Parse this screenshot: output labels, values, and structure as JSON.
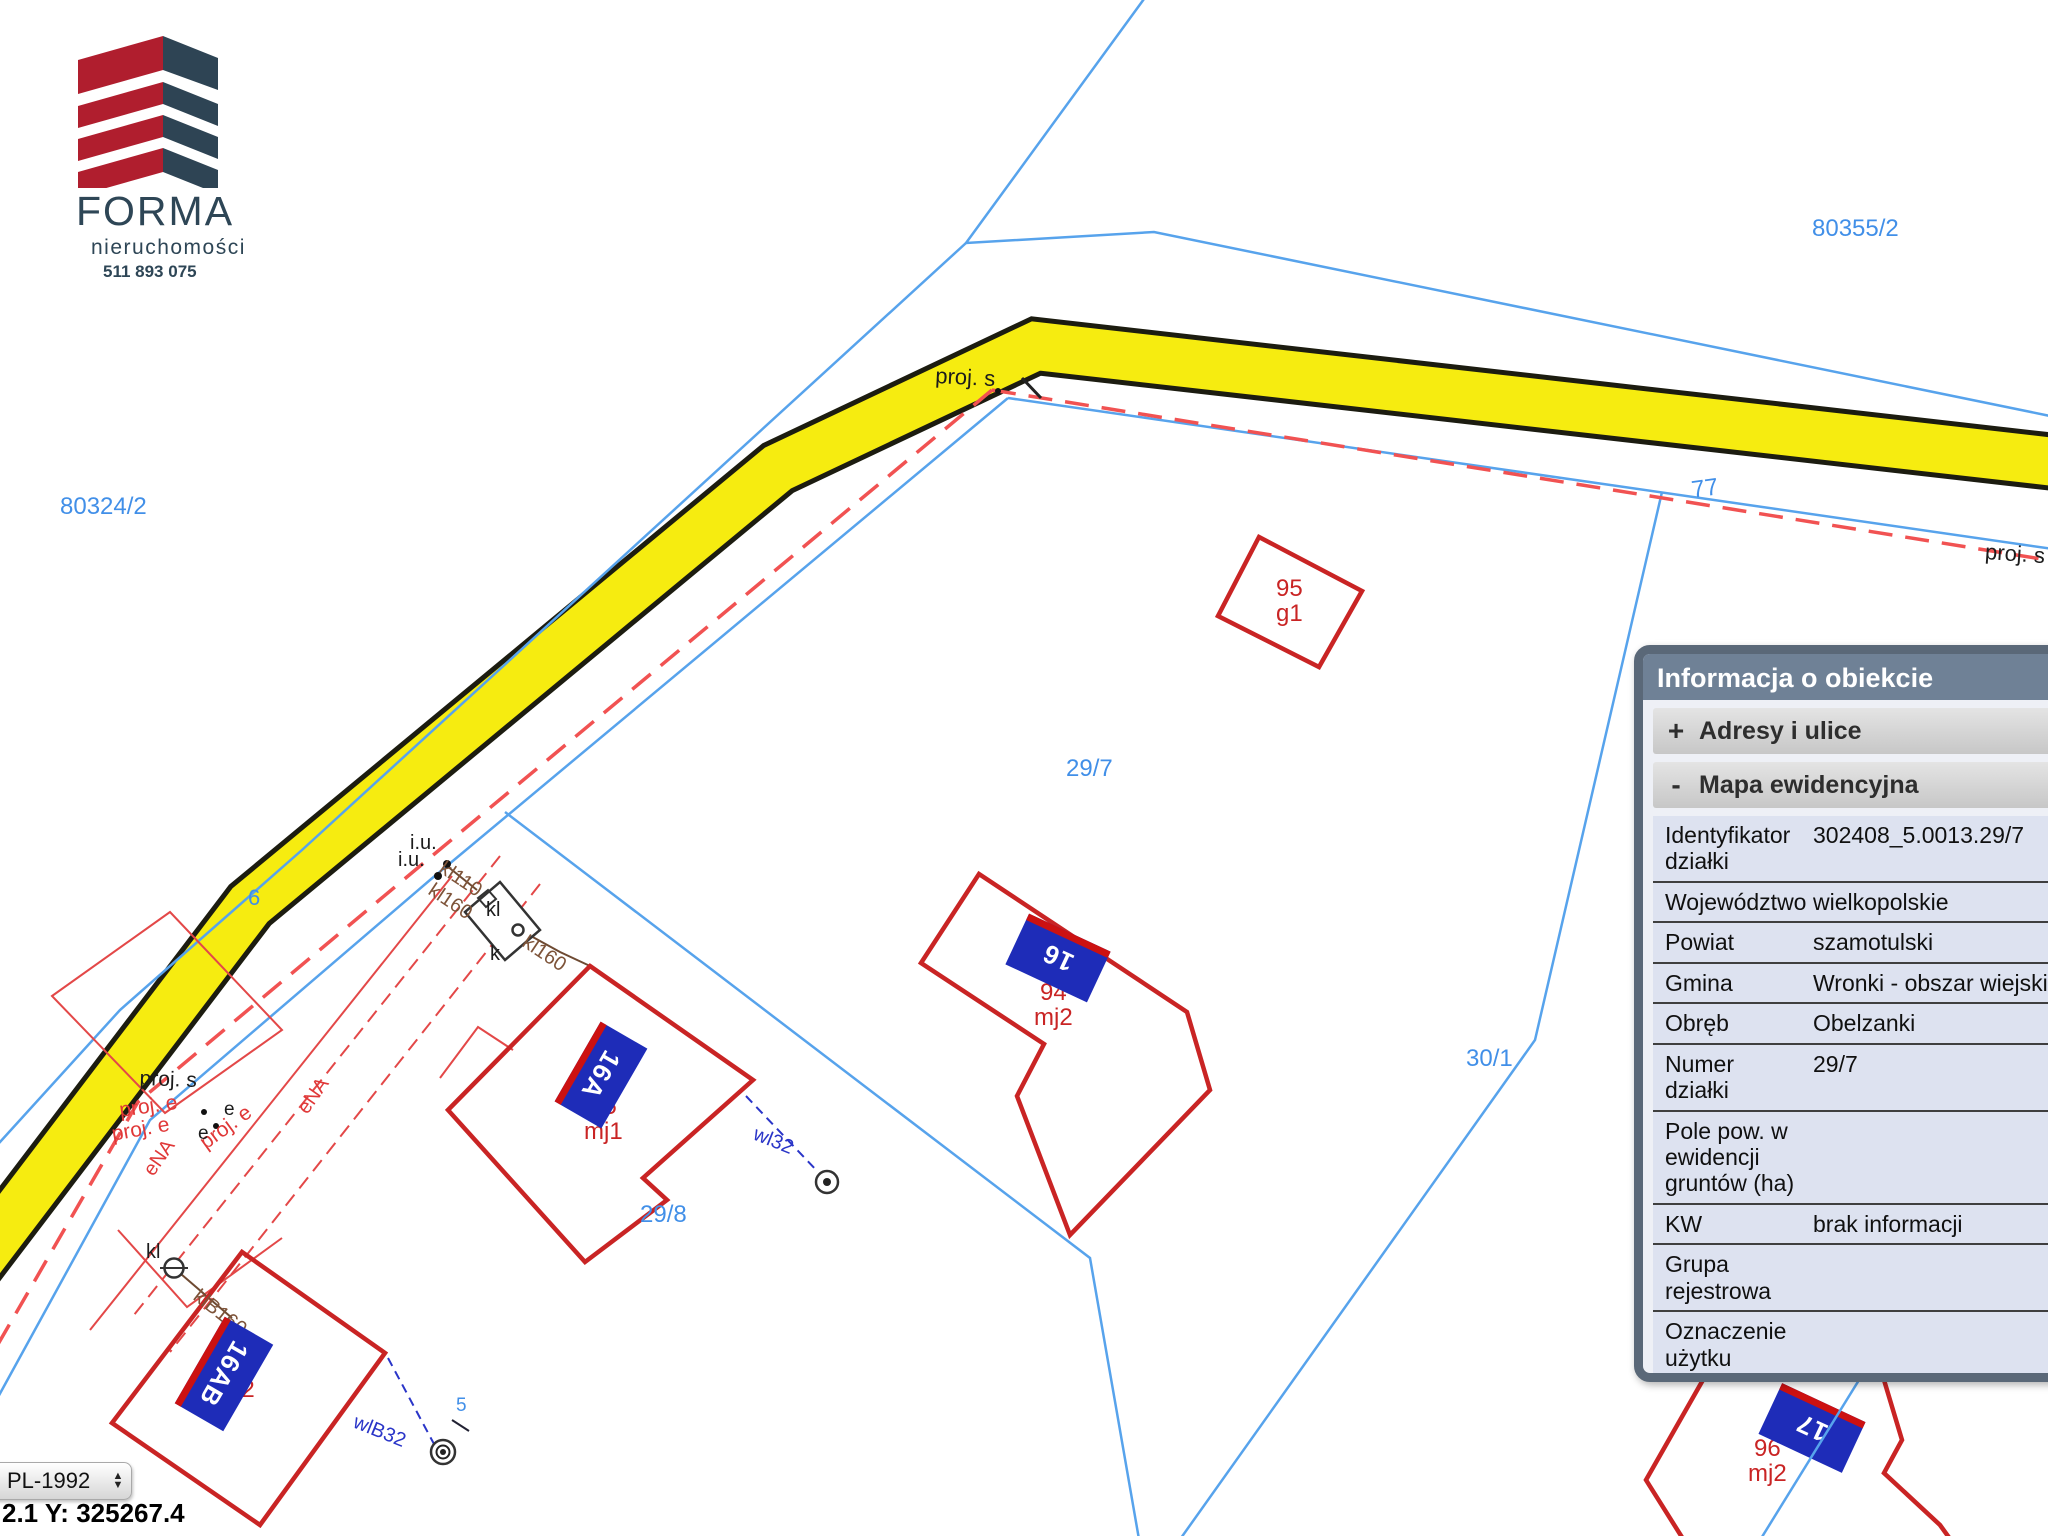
{
  "logo": {
    "company": "FORMA",
    "subtitle": "nieruchomości",
    "phone": "511 893 075"
  },
  "map": {
    "colors": {
      "line-blue": "#57a3ec",
      "label-blue": "#418fe8",
      "road-yellow": "#f6ec10",
      "road-edge": "#1c1c10",
      "building-red": "#c92424",
      "thin-red": "#e34848",
      "dash-red": "#f15252",
      "brown": "#6e4a32",
      "label-brown": "#7d5338",
      "utility-blue": "#2a35c8",
      "plate-blue": "#1e2cb8",
      "plate-stripe": "#cc1111"
    },
    "labels": [
      {
        "name": "parcel-80355-2",
        "text": "80355/2",
        "type": "parcel"
      },
      {
        "name": "parcel-80324-2",
        "text": "80324/2",
        "type": "parcel"
      },
      {
        "name": "parcel-29-7",
        "text": "29/7",
        "type": "parcel"
      },
      {
        "name": "parcel-30-1",
        "text": "30/1",
        "type": "parcel"
      },
      {
        "name": "parcel-29-8",
        "text": "29/8",
        "type": "parcel"
      },
      {
        "name": "parcel-77",
        "text": "77",
        "type": "parcel"
      },
      {
        "name": "parcel-6",
        "text": "6",
        "type": "parcel"
      },
      {
        "name": "point-5",
        "text": "5",
        "type": "parcel"
      },
      {
        "name": "proj-s-bend",
        "text": "proj. s",
        "type": "utility-black"
      },
      {
        "name": "proj-s-right",
        "text": "proj. s",
        "type": "utility-black"
      },
      {
        "name": "proj-s-left",
        "text": "proj. s",
        "type": "utility-black"
      },
      {
        "name": "proj-e-1",
        "text": "proj. e",
        "type": "utility-red"
      },
      {
        "name": "proj-e-2",
        "text": "proj. e",
        "type": "utility-red"
      },
      {
        "name": "proj-e-3",
        "text": "proj. e",
        "type": "utility-red"
      },
      {
        "name": "ena-1",
        "text": "eNA",
        "type": "utility-red"
      },
      {
        "name": "ena-2",
        "text": "eNA",
        "type": "utility-red"
      },
      {
        "name": "iu-1",
        "text": "i.u.",
        "type": "utility-black"
      },
      {
        "name": "iu-2",
        "text": "i.u.",
        "type": "utility-black"
      },
      {
        "name": "kl110",
        "text": "kl110",
        "type": "utility-brown"
      },
      {
        "name": "kl160-a",
        "text": "kl160",
        "type": "utility-brown"
      },
      {
        "name": "kl160-b",
        "text": "kl160",
        "type": "utility-brown"
      },
      {
        "name": "klb160",
        "text": "klB160",
        "type": "utility-brown"
      },
      {
        "name": "kl-tank",
        "text": "kl",
        "type": "utility-black"
      },
      {
        "name": "k-tank",
        "text": "k",
        "type": "utility-black"
      },
      {
        "name": "kl-circle",
        "text": "kl",
        "type": "utility-black"
      },
      {
        "name": "wl32",
        "text": "wl32",
        "type": "utility-blue"
      },
      {
        "name": "wlb32",
        "text": "wlB32",
        "type": "utility-blue"
      },
      {
        "name": "e-1",
        "text": "e",
        "type": "utility-black"
      },
      {
        "name": "e-2",
        "text": "e",
        "type": "utility-black"
      },
      {
        "name": "building-95-g1",
        "text": "95\ng1",
        "type": "building"
      },
      {
        "name": "building-94-mj2",
        "text": "94\nmj2",
        "type": "building"
      },
      {
        "name": "building-95-mj1",
        "text": "95\nmj1",
        "type": "building"
      },
      {
        "name": "building-92-mj2",
        "text": "92\nmj2",
        "type": "building"
      },
      {
        "name": "building-96-mj2",
        "text": "96\nmj2",
        "type": "building"
      }
    ],
    "plates": [
      {
        "name": "plate-16",
        "text": "16"
      },
      {
        "name": "plate-16a",
        "text": "16A"
      },
      {
        "name": "plate-16ab",
        "text": "16AB"
      },
      {
        "name": "plate-17",
        "text": "17"
      }
    ]
  },
  "panel": {
    "title": "Informacja o obiekcie",
    "sections": [
      {
        "toggle": "+",
        "label": "Adresy i ulice"
      },
      {
        "toggle": "-",
        "label": "Mapa ewidencyjna"
      }
    ],
    "rows": [
      {
        "label": "Identyfikator działki",
        "value": "302408_5.0013.29/7"
      },
      {
        "label": "Województwo",
        "value": "wielkopolskie"
      },
      {
        "label": "Powiat",
        "value": "szamotulski"
      },
      {
        "label": "Gmina",
        "value": "Wronki - obszar wiejski"
      },
      {
        "label": "Obręb",
        "value": "Obelzanki"
      },
      {
        "label": "Numer działki",
        "value": "29/7"
      },
      {
        "label": "Pole pow. w ewidencji gruntów (ha)",
        "value": ""
      },
      {
        "label": "KW",
        "value": "brak informacji"
      },
      {
        "label": "Grupa rejestrowa",
        "value": ""
      },
      {
        "label": "Oznaczenie użytku",
        "value": ""
      },
      {
        "label": "Oznaczenie konturu",
        "value": ""
      }
    ]
  },
  "controls": {
    "crs": "PL-1992",
    "coords": "2.1   Y: 325267.4"
  }
}
